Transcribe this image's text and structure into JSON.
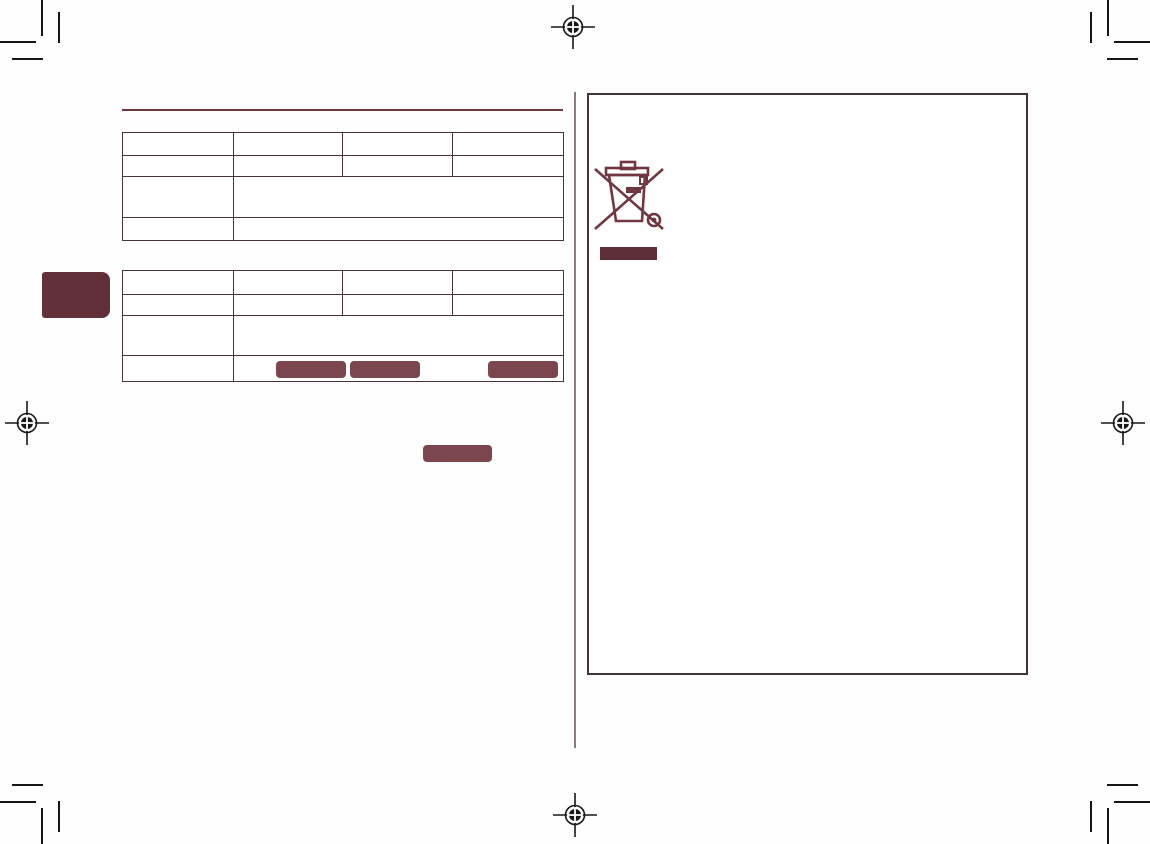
{
  "page": {
    "kind": "scanned-print-layout-page",
    "background": "#fefefe",
    "visible_text": ""
  },
  "colors": {
    "accent_maroon_dark": "#602f38",
    "accent_maroon_mid": "#7b464d",
    "icon_maroon": "#713740",
    "table_border": "#4b3138",
    "panel_border": "#463339",
    "fold_divider": "#8d7a80",
    "print_mark": "#161616"
  },
  "print_marks": {
    "registration_targets": 4,
    "corner_crop_mark_sets": 4
  },
  "left_page": {
    "section_rule": {
      "present": true
    },
    "edge_tab": {
      "label": ""
    },
    "tables": [
      {
        "name": "spec-table-1",
        "columns": 4,
        "rows": [
          [
            "",
            "",
            "",
            ""
          ],
          [
            "",
            "",
            "",
            ""
          ],
          [
            "",
            ""
          ],
          [
            "",
            ""
          ]
        ]
      },
      {
        "name": "spec-table-2",
        "columns": 4,
        "rows": [
          [
            "",
            "",
            "",
            ""
          ],
          [
            "",
            "",
            "",
            ""
          ],
          [
            "",
            ""
          ],
          [
            "",
            ""
          ]
        ],
        "redacted_blocks_in_last_row": 3
      }
    ],
    "standalone_redacted_block": 1
  },
  "right_page": {
    "panel": {
      "content": ""
    },
    "icons": [
      {
        "name": "weee-crossed-bin-icon",
        "meaning": "crossed-out wheeled bin recycling symbol"
      },
      {
        "name": "weee-black-bar",
        "meaning": "solid bar beneath WEEE symbol"
      }
    ]
  }
}
